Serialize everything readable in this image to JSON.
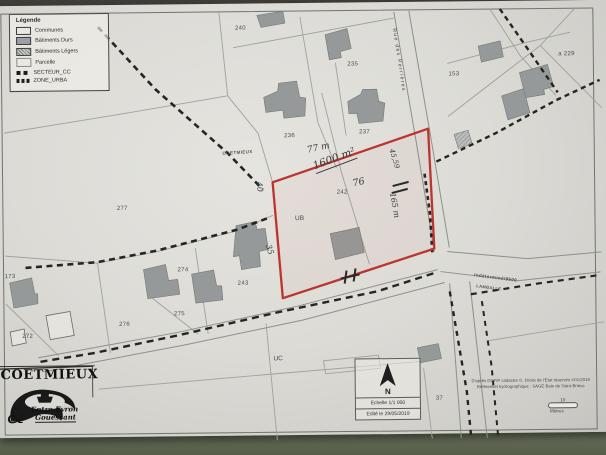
{
  "legend": {
    "title": "Légende",
    "items": [
      {
        "label": "Communes"
      },
      {
        "label": "Bâtiments Durs"
      },
      {
        "label": "Bâtiments Légers"
      },
      {
        "label": "Parcelle"
      },
      {
        "label": "SECTEUR_CC"
      },
      {
        "label": "ZONE_URBA"
      }
    ]
  },
  "map": {
    "parcels": [
      {
        "label": "240"
      },
      {
        "label": "235"
      },
      {
        "label": "236"
      },
      {
        "label": "237"
      },
      {
        "label": "153"
      },
      {
        "label": "a 229"
      },
      {
        "label": "277"
      },
      {
        "label": "173"
      },
      {
        "label": "272"
      },
      {
        "label": "274"
      },
      {
        "label": "275"
      },
      {
        "label": "243"
      },
      {
        "label": "242"
      },
      {
        "label": "276"
      },
      {
        "label": "37"
      }
    ],
    "zones": [
      {
        "label": "UB"
      },
      {
        "label": "UC"
      }
    ],
    "roads": {
      "rue": "Rue des Perrières",
      "route_class": "Indéterminé/9500",
      "destination": "LAMBALLE"
    },
    "commune_boundary_label": "COETMIEUX",
    "handwritten": [
      {
        "text": "77 m"
      },
      {
        "text": "1600 m²"
      },
      {
        "text": "76"
      },
      {
        "text": "40"
      },
      {
        "text": "35"
      },
      {
        "text": "45,59"
      },
      {
        "text": "165 m"
      }
    ],
    "colors": {
      "parcel_outline_red": "#bc342e",
      "boundary_dashed": "#262522",
      "building_fill": "#96999a",
      "paper": "#dcdbd6"
    }
  },
  "scale_box": {
    "north": "N",
    "scale": "Echelle 1/1 000",
    "edition": "Edité le 29/05/2019"
  },
  "stamp": {
    "commune": "COETMIEUX",
    "logo_line1": "Entre Evron",
    "logo_line2": "Gouessant"
  },
  "credits": {
    "line1": "D'après DGFiP cadastre ©, Droits de l'Etat réservés ©01/2019",
    "line2": "Référentiel hydrographique : SAGE Baie de Saint-Brieuc"
  },
  "scalebar": {
    "value": "10",
    "unit": "Mètres"
  }
}
